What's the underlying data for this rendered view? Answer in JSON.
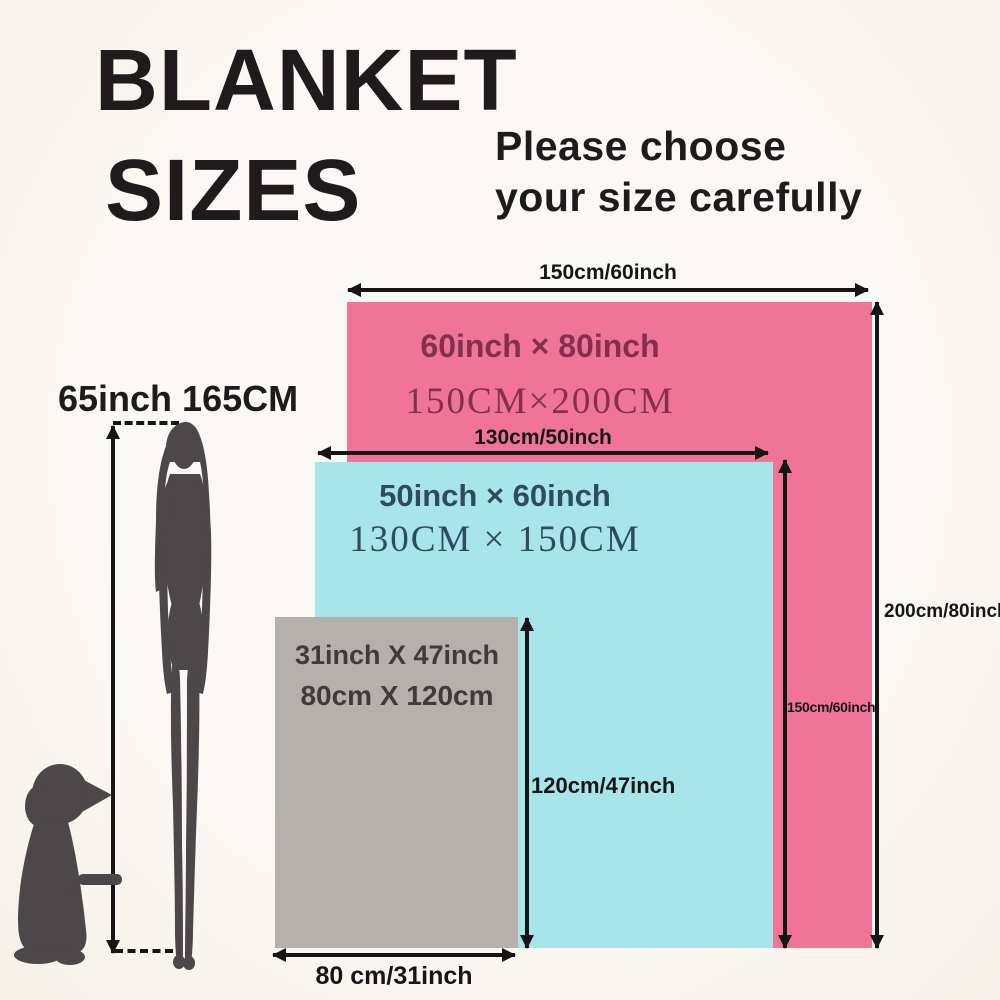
{
  "title": {
    "line1": "BLANKET",
    "line2": "SIZES"
  },
  "subtitle": {
    "line1": "Please choose",
    "line2": "your size carefully"
  },
  "scale_figure": {
    "height_label": "65inch 165CM",
    "woman": "standing-woman-silhouette",
    "dog": "sitting-dog-silhouette"
  },
  "blankets": {
    "large": {
      "size_inch": "60inch × 80inch",
      "size_cm": "150CM×200CM",
      "width_label": "150cm/60inch",
      "height_label": "200cm/80inch",
      "fill": "#ef7497",
      "text_color": "#83304f"
    },
    "medium": {
      "size_inch": "50inch × 60inch",
      "size_cm": "130CM × 150CM",
      "width_label": "130cm/50inch",
      "height_label": "150cm/60inch",
      "fill": "#a7e5ea",
      "text_color": "#2f4b63"
    },
    "small": {
      "size_inch": "31inch X 47inch",
      "size_cm": "80cm X 120cm",
      "width_label": "80 cm/31inch",
      "height_label": "120cm/47inch",
      "fill": "#b5b0ac",
      "text_color": "#3d3c3c"
    }
  },
  "colors": {
    "background": "#faf8f3",
    "headline_text": "#1d1b1c",
    "arrow": "#151515",
    "silhouette": "#4c4749"
  }
}
